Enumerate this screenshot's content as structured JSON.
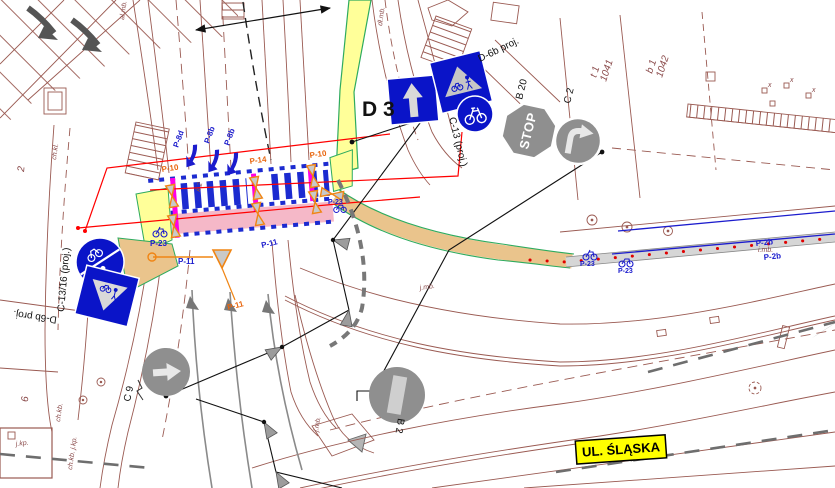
{
  "colors": {
    "basemap_brown": "#9a5a52",
    "sign_blue": "#0a14c8",
    "marking_blue": "#1c1ccd",
    "existing_sign_gray": "#8f8f8f",
    "crossing_pink": "#f5b8c8",
    "magenta": "#ff00e6",
    "surface_yellow": "#ffff99",
    "surface_tan": "#eac48c",
    "edge_green": "#2eab5e",
    "leader_red": "#ff0000",
    "marker_orange": "#f08514",
    "label_yellow": "#ffff00"
  },
  "signs": {
    "d3_label": "D 3",
    "d6b_right_label": "D-6b proj.",
    "c13_label": "C-13 (proj.)",
    "b20_label": "B 20",
    "c2_label": "C 2",
    "stop_text": "STOP",
    "c13_16_label": "C-13/16 (proj.)",
    "d6b_left_label": "D-6b proj.",
    "b2_label": "B 2",
    "c9_label": "C 9"
  },
  "street_label": "UL. ŚLĄSKA",
  "markings": {
    "p10_left": "P-10",
    "p14": "P-14",
    "p10_right": "P-10",
    "p8d": "P-8d",
    "p8b_a": "P-8b",
    "p8b_b": "P-8b",
    "p23_left": "P-23",
    "p23_mid": "P-23",
    "p23_right_a": "P-23",
    "p23_right_b": "P-23",
    "p11_a": "P-11",
    "p11_b": "P-11",
    "p11_c": "P-11",
    "p2b_a": "P-2b",
    "p2b_b": "P-2b",
    "k2": "k 2"
  },
  "parcels": {
    "p1_id": "t 1",
    "p1_num": "1041",
    "p2_id": "b 1",
    "p2_num": "1042"
  },
  "map_notes": {
    "almb": "al.mb.",
    "dlmb": "dł.mb.",
    "chkl": "ch.kl.",
    "jmb_a": "j.mb.",
    "jmb_b": "j.mb.",
    "imb": "i.mb.",
    "jkp": "j.kp.",
    "chkb": "ch.kb.",
    "chkb_jkp": "ch.kb. j.kp.",
    "n2": "2",
    "n6": "6",
    "survey_x": "x"
  }
}
